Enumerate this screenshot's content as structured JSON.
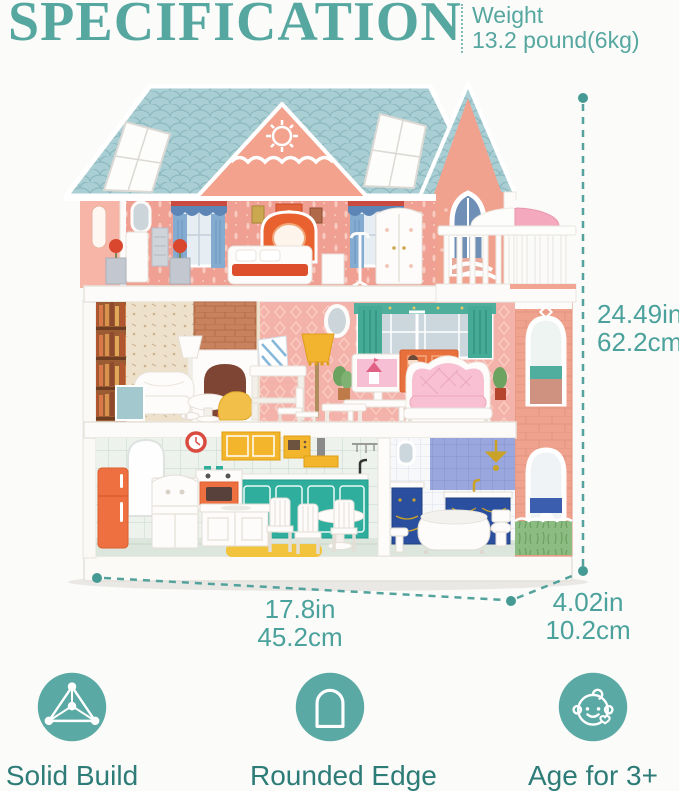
{
  "header": {
    "title": "SPECIFICATION",
    "weight_label": "Weight",
    "weight_value": "13.2 pound(6kg)"
  },
  "dimensions": {
    "height": {
      "inches": "24.49in",
      "centimeters": "62.2cm"
    },
    "width": {
      "inches": "17.8in",
      "centimeters": "45.2cm"
    },
    "depth": {
      "inches": "4.02in",
      "centimeters": "10.2cm"
    }
  },
  "features": [
    {
      "icon": "solid-build-icon",
      "label": "Solid Build"
    },
    {
      "icon": "rounded-edge-icon",
      "label": "Rounded Edge"
    },
    {
      "icon": "baby-face-icon",
      "label": "Age for 3+"
    }
  ],
  "illustration": {
    "icon": "dollhouse-photo"
  },
  "colors": {
    "accent_teal": "#57a7a1",
    "dimension_teal": "#4ba19b",
    "feature_label_teal": "#2e7c78",
    "icon_circle_teal": "#5ba9a4",
    "roof_blue": "#a9ced3",
    "house_pink": "#f0a294",
    "cabinet_teal": "#2fae9e",
    "cabinet_yellow": "#f3b52b",
    "appliance_orange": "#ee7040",
    "sofa_pink": "#f8c0d2",
    "bath_vanity_blue": "#2b4f9f",
    "grass_green": "#8cbc82"
  }
}
